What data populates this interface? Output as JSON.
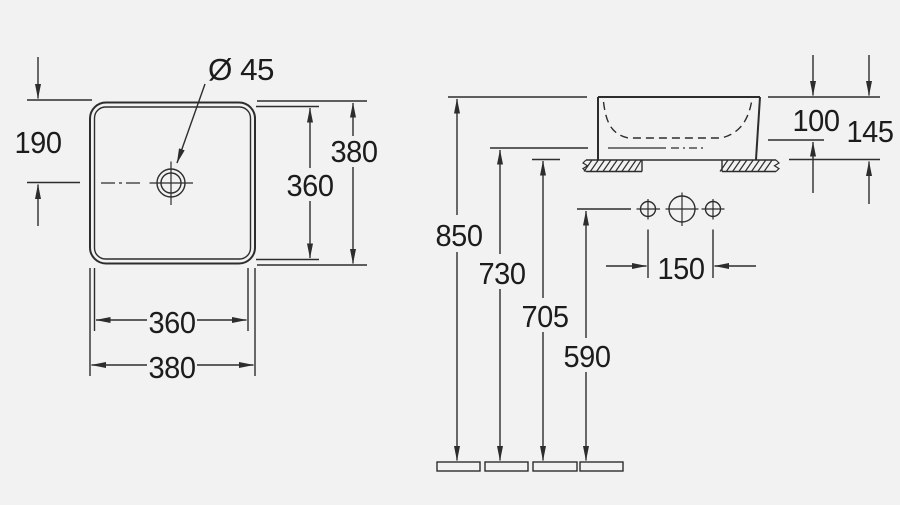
{
  "drawing": {
    "type": "technical-dimension-drawing",
    "background_color": "#f2f2f2",
    "line_color": "#2d2d2d",
    "top_view": {
      "description": "square countertop basin, plan view",
      "drain_diameter_label": "Ø 45",
      "drain_offset_from_top": "190",
      "outer_height": "380",
      "inner_height": "360",
      "inner_width": "360",
      "outer_width": "380"
    },
    "side_view": {
      "description": "basin side elevation with installation heights",
      "basin_inner_depth": "100",
      "basin_total_height": "145",
      "height_rim": "850",
      "height_730": "730",
      "height_countertop": "705",
      "height_tap_holes": "590",
      "tap_hole_spacing": "150"
    }
  }
}
